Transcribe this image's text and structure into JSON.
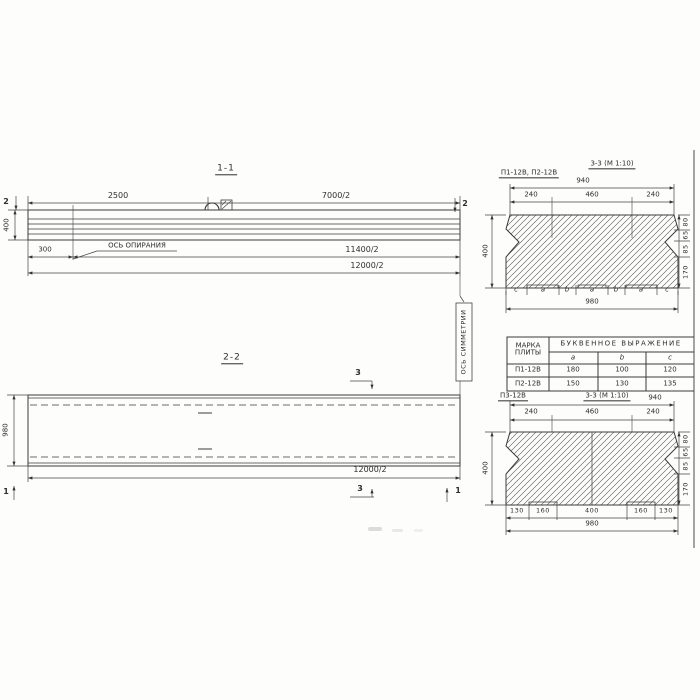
{
  "s11": {
    "title": "1-1",
    "marker": "2",
    "dim_top_left": "2500",
    "dim_top_right": "7000/2",
    "height": "400",
    "offset": "300",
    "bearing_axis_label": "ОСЬ ОПИРАНИЯ",
    "dim_bearing": "11400/2",
    "dim_total": "12000/2"
  },
  "s22": {
    "title": "2-2",
    "marker_3": "3",
    "marker_1": "1",
    "height": "980",
    "dim_total": "12000/2",
    "symmetry_axis_label": "ОСЬ СИММЕТРИИ"
  },
  "s33_top": {
    "subtitle": "П1-12В, П2-12В",
    "title": "3-3 (М 1:10)",
    "dim_940": "940",
    "segs": [
      "240",
      "460",
      "240"
    ],
    "height": "400",
    "right_dims": [
      "80",
      "65",
      "85",
      "170"
    ],
    "letters": [
      "c",
      "a",
      "b",
      "a",
      "b",
      "a",
      "c"
    ],
    "dim_980": "980"
  },
  "s33_bot": {
    "subtitle": "П3-12В",
    "title": "3-3 (М 1:10)",
    "dim_940": "940",
    "segs": [
      "240",
      "460",
      "240"
    ],
    "height": "400",
    "right_dims": [
      "80",
      "65",
      "85",
      "170"
    ],
    "bottom_segs": [
      "130",
      "160",
      "400",
      "160",
      "130"
    ],
    "dim_980": "980"
  },
  "table": {
    "marka_header": "МАРКА ПЛИТЫ",
    "group_header": "БУКВЕННОЕ ВЫРАЖЕНИЕ",
    "columns": [
      "a",
      "b",
      "c"
    ],
    "rows": [
      [
        "П1-12В",
        "180",
        "100",
        "120"
      ],
      [
        "П2-12В",
        "150",
        "130",
        "135"
      ]
    ]
  }
}
